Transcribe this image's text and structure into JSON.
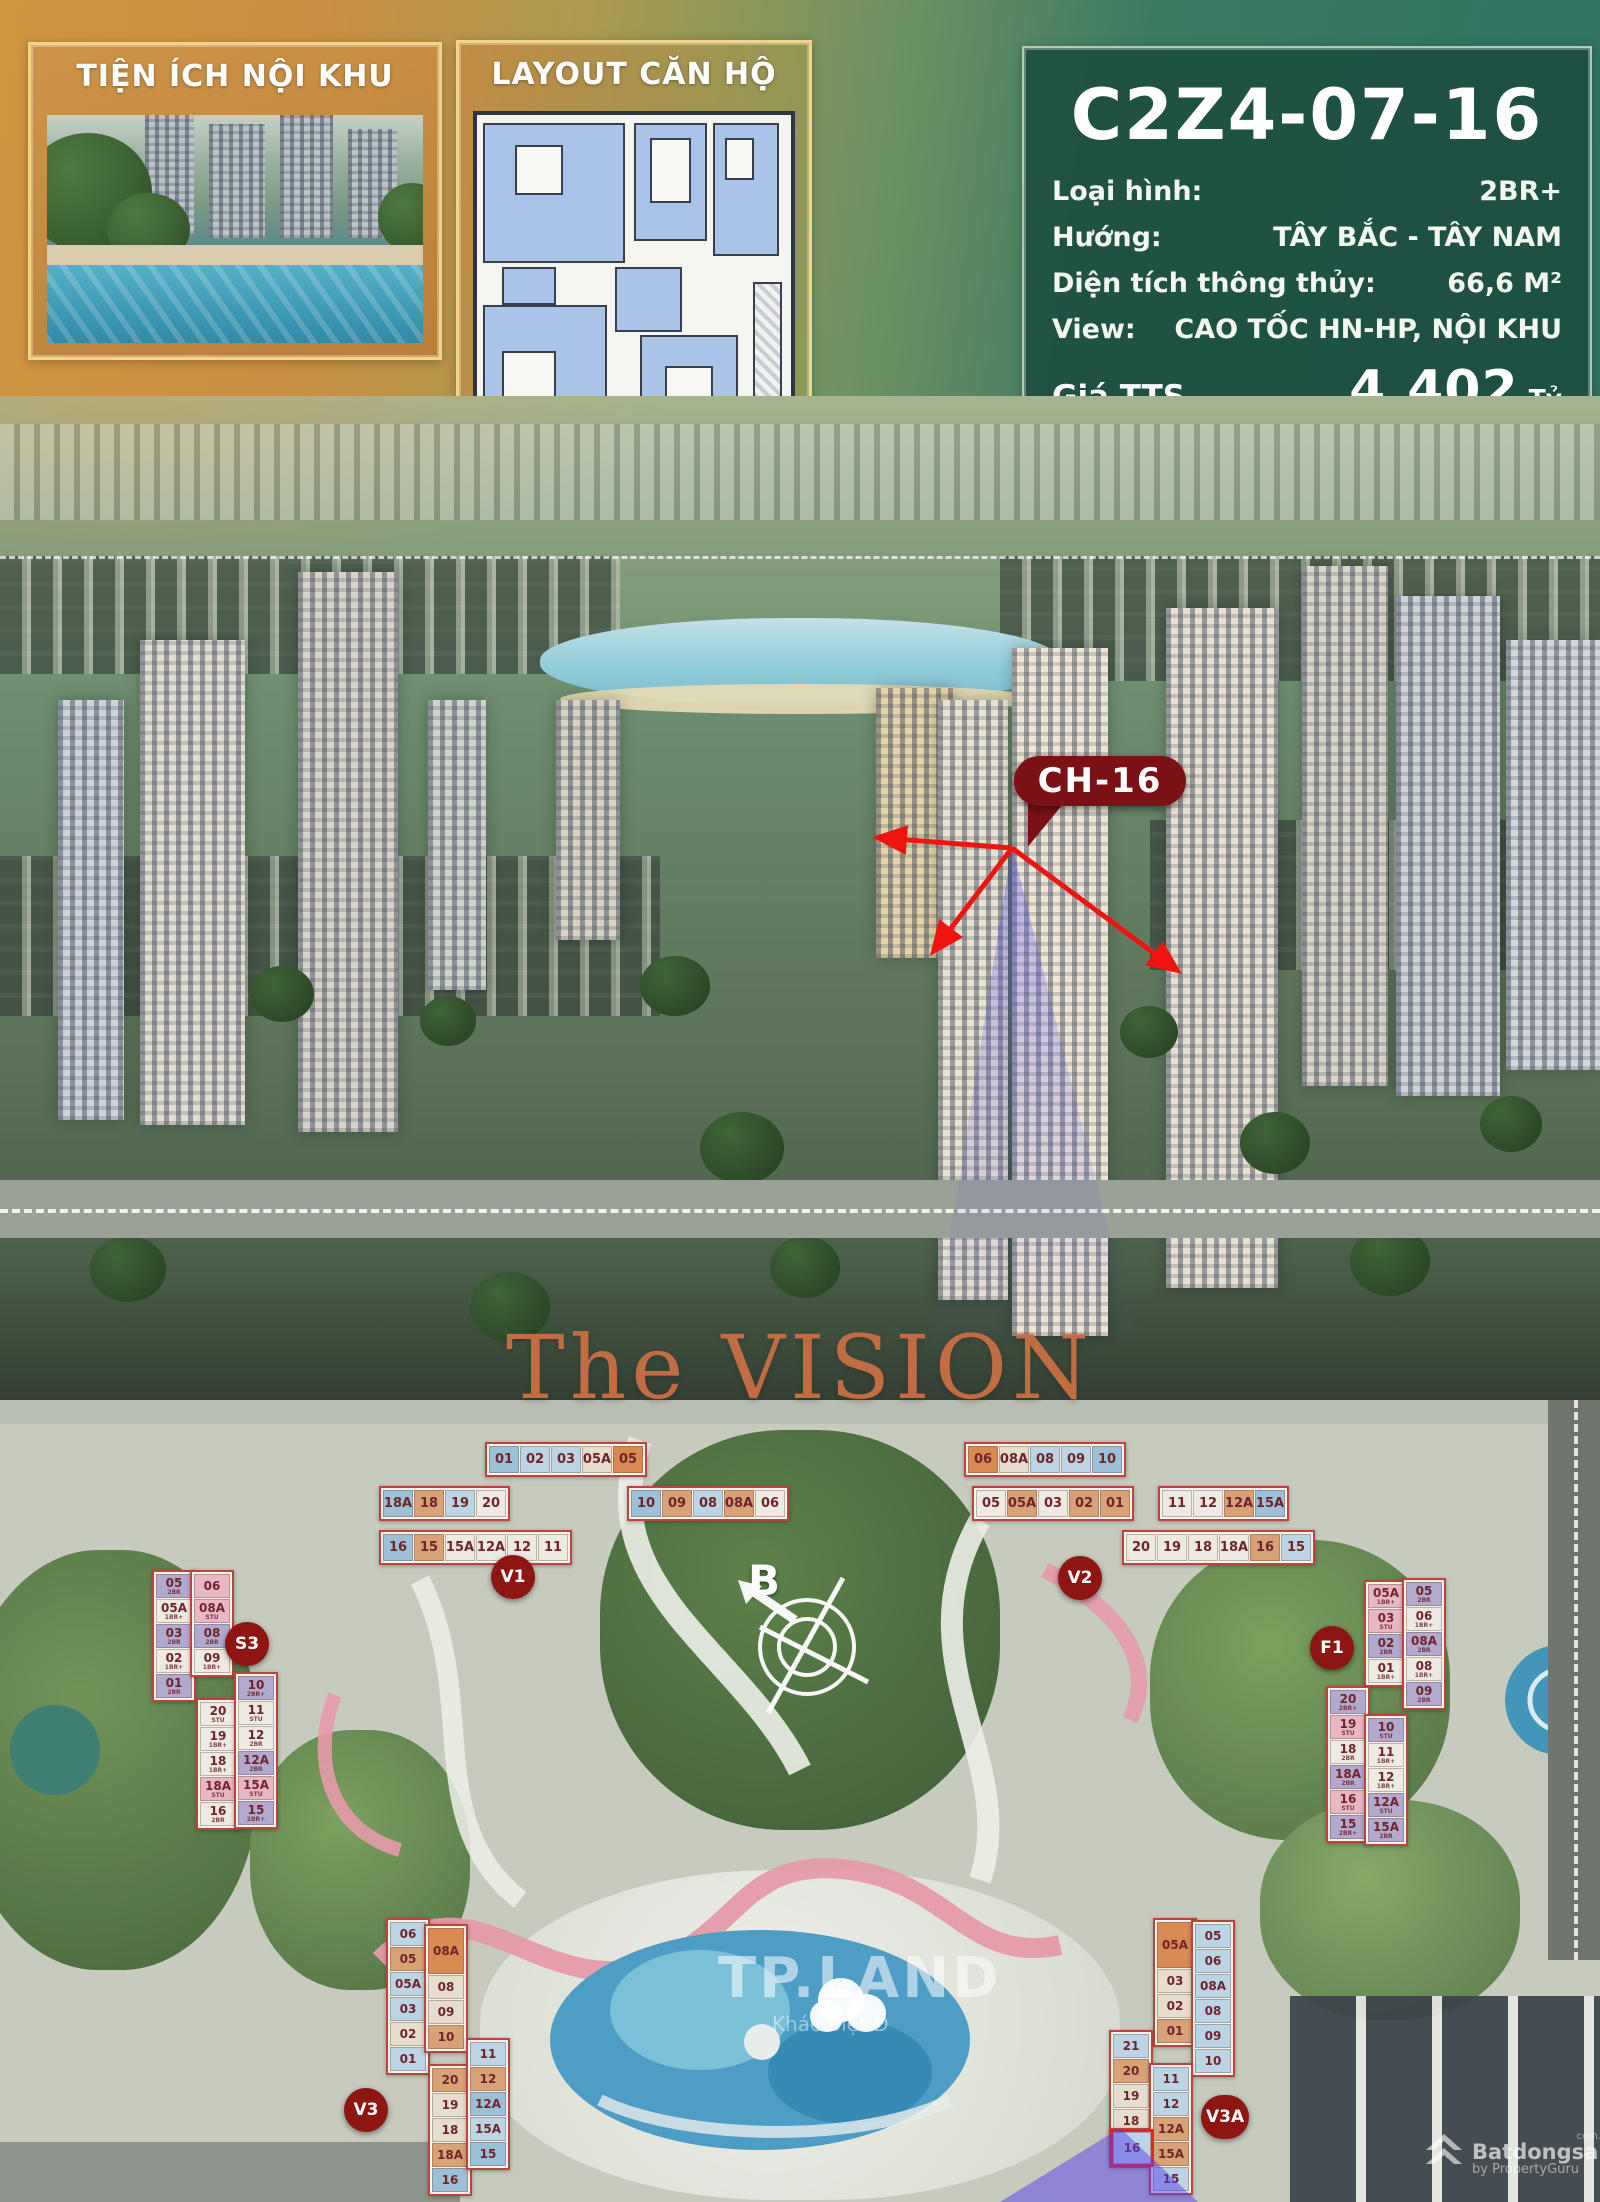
{
  "header": {
    "left_panel_title": "TIỆN ÍCH NỘI KHU",
    "mid_panel_title": "LAYOUT CĂN HỘ",
    "unit_code": "C2Z4-07-16",
    "specs": [
      {
        "label": "Loại hình:",
        "value": "2BR+"
      },
      {
        "label": "Hướng:",
        "value": "TÂY BẮC - TÂY NAM"
      },
      {
        "label": "Diện tích thông thủy:",
        "value": "66,6 M²"
      },
      {
        "label": "View:",
        "value": "CAO TỐC HN-HP, NỘI KHU"
      }
    ],
    "prices": [
      {
        "label": "Giá TTS",
        "value": "4.402",
        "unit": "Tỷ"
      },
      {
        "label": "Giá TTTĐ",
        "value": "4.757",
        "unit": "Tỷ"
      },
      {
        "label": "Giá Vay",
        "value": "5.061",
        "unit": "Tỷ"
      }
    ]
  },
  "aerial": {
    "callout": "CH-16"
  },
  "section_title": "The VISION",
  "site_plan": {
    "compass_label": "B",
    "watermark": {
      "title": "TP.LAND",
      "subtitle": "Khác Biệt Đ"
    },
    "brand": {
      "name": "Batdongsan",
      "domain": "com.vn",
      "byline": "by PropertyGuru"
    },
    "highlight_unit": "16",
    "palette": {
      "b1": "#bcd5e4",
      "b2": "#9cc0d8",
      "tn": "#d7a376",
      "or": "#d98a52",
      "cr": "#e6decd",
      "wh": "#edeae2",
      "lv": "#b2a9ce",
      "pk": "#e8b7c4"
    },
    "buildings": [
      {
        "id": "V1",
        "kind": "h",
        "x": 373,
        "y": 1430,
        "badge": {
          "x": 118,
          "y": 125
        },
        "blocks": [
          {
            "x": 112,
            "y": 12,
            "dir": "row",
            "cells": [
              {
                "t": "01",
                "c": "b2"
              },
              {
                "t": "02",
                "c": "b1"
              },
              {
                "t": "03",
                "c": "b1"
              },
              {
                "t": "05A",
                "c": "cr"
              },
              {
                "t": "05",
                "c": "or"
              }
            ]
          },
          {
            "x": 6,
            "y": 56,
            "dir": "row",
            "cells": [
              {
                "t": "18A",
                "c": "b2"
              },
              {
                "t": "18",
                "c": "tn"
              },
              {
                "t": "19",
                "c": "b1"
              },
              {
                "t": "20",
                "c": "wh"
              }
            ]
          },
          {
            "x": 254,
            "y": 56,
            "dir": "row",
            "cells": [
              {
                "t": "10",
                "c": "b2"
              },
              {
                "t": "09",
                "c": "tn"
              },
              {
                "t": "08",
                "c": "b1"
              },
              {
                "t": "08A",
                "c": "tn"
              },
              {
                "t": "06",
                "c": "wh"
              }
            ]
          },
          {
            "x": 6,
            "y": 100,
            "dir": "row",
            "cells": [
              {
                "t": "16",
                "c": "b2"
              },
              {
                "t": "15",
                "c": "tn"
              },
              {
                "t": "15A",
                "c": "wh"
              },
              {
                "t": "12A",
                "c": "wh"
              },
              {
                "t": "12",
                "c": "wh"
              },
              {
                "t": "11",
                "c": "wh"
              }
            ]
          }
        ]
      },
      {
        "id": "V2",
        "kind": "h",
        "x": 962,
        "y": 1438,
        "badge": {
          "x": 96,
          "y": 118
        },
        "blocks": [
          {
            "x": 2,
            "y": 4,
            "dir": "row",
            "cells": [
              {
                "t": "06",
                "c": "or"
              },
              {
                "t": "08A",
                "c": "cr"
              },
              {
                "t": "08",
                "c": "b1"
              },
              {
                "t": "09",
                "c": "b1"
              },
              {
                "t": "10",
                "c": "b2"
              }
            ]
          },
          {
            "x": 10,
            "y": 48,
            "dir": "row",
            "cells": [
              {
                "t": "05",
                "c": "wh"
              },
              {
                "t": "05A",
                "c": "tn"
              },
              {
                "t": "03",
                "c": "wh"
              },
              {
                "t": "02",
                "c": "tn"
              },
              {
                "t": "01",
                "c": "tn"
              }
            ]
          },
          {
            "x": 196,
            "y": 48,
            "dir": "row",
            "cells": [
              {
                "t": "11",
                "c": "wh"
              },
              {
                "t": "12",
                "c": "wh"
              },
              {
                "t": "12A",
                "c": "tn"
              },
              {
                "t": "15A",
                "c": "b2"
              }
            ]
          },
          {
            "x": 160,
            "y": 92,
            "dir": "row",
            "cells": [
              {
                "t": "20",
                "c": "wh"
              },
              {
                "t": "19",
                "c": "wh"
              },
              {
                "t": "18",
                "c": "wh"
              },
              {
                "t": "18A",
                "c": "wh"
              },
              {
                "t": "16",
                "c": "tn"
              },
              {
                "t": "15",
                "c": "b1"
              }
            ]
          }
        ]
      },
      {
        "id": "S3",
        "kind": "v",
        "x": 130,
        "y": 1566,
        "badge": {
          "x": 95,
          "y": 56
        },
        "blocks": [
          {
            "x": 22,
            "y": 4,
            "dir": "col",
            "cells": [
              {
                "t": "05",
                "c": "lv",
                "sub": "2BR"
              },
              {
                "t": "05A",
                "c": "wh",
                "sub": "1BR+"
              },
              {
                "t": "03",
                "c": "lv",
                "sub": "2BR"
              },
              {
                "t": "02",
                "c": "wh",
                "sub": "1BR+"
              },
              {
                "t": "01",
                "c": "lv",
                "sub": "2BR"
              }
            ]
          },
          {
            "x": 60,
            "y": 4,
            "dir": "col",
            "cells": [
              {
                "t": "06",
                "c": "pk"
              },
              {
                "t": "08A",
                "c": "pk",
                "sub": "STU"
              },
              {
                "t": "08",
                "c": "lv",
                "sub": "2BR"
              },
              {
                "t": "09",
                "c": "wh",
                "sub": "1BR+"
              }
            ]
          },
          {
            "x": 66,
            "y": 132,
            "dir": "col",
            "cells": [
              {
                "t": "20",
                "c": "wh",
                "sub": "STU"
              },
              {
                "t": "19",
                "c": "wh",
                "sub": "1BR+"
              },
              {
                "t": "18",
                "c": "wh",
                "sub": "1BR+"
              },
              {
                "t": "18A",
                "c": "pk",
                "sub": "STU"
              },
              {
                "t": "16",
                "c": "wh",
                "sub": "2BR"
              }
            ]
          },
          {
            "x": 104,
            "y": 106,
            "dir": "col",
            "cells": [
              {
                "t": "10",
                "c": "lv",
                "sub": "2BR+"
              },
              {
                "t": "11",
                "c": "wh",
                "sub": "STU"
              },
              {
                "t": "12",
                "c": "wh",
                "sub": "2BR"
              },
              {
                "t": "12A",
                "c": "lv",
                "sub": "2BR"
              },
              {
                "t": "15A",
                "c": "pk",
                "sub": "STU"
              },
              {
                "t": "15",
                "c": "lv",
                "sub": "2BR+"
              }
            ]
          }
        ]
      },
      {
        "id": "F1",
        "kind": "v",
        "x": 1300,
        "y": 1578,
        "badge": {
          "x": 10,
          "y": 48
        },
        "blocks": [
          {
            "x": 64,
            "y": 2,
            "dir": "col",
            "cells": [
              {
                "t": "05A",
                "c": "pk",
                "sub": "1BR+"
              },
              {
                "t": "03",
                "c": "pk",
                "sub": "STU"
              },
              {
                "t": "02",
                "c": "lv",
                "sub": "2BR"
              },
              {
                "t": "01",
                "c": "wh",
                "sub": "1BR+"
              }
            ]
          },
          {
            "x": 102,
            "y": 0,
            "dir": "col",
            "cells": [
              {
                "t": "05",
                "c": "lv",
                "sub": "2BR"
              },
              {
                "t": "06",
                "c": "wh",
                "sub": "1BR+"
              },
              {
                "t": "08A",
                "c": "lv",
                "sub": "2BR"
              },
              {
                "t": "08",
                "c": "wh",
                "sub": "1BR+"
              },
              {
                "t": "09",
                "c": "lv",
                "sub": "2BR"
              }
            ]
          },
          {
            "x": 26,
            "y": 108,
            "dir": "col",
            "cells": [
              {
                "t": "20",
                "c": "lv",
                "sub": "2BR+"
              },
              {
                "t": "19",
                "c": "pk",
                "sub": "STU"
              },
              {
                "t": "18",
                "c": "wh",
                "sub": "2BR"
              },
              {
                "t": "18A",
                "c": "lv",
                "sub": "2BR"
              },
              {
                "t": "16",
                "c": "pk",
                "sub": "STU"
              },
              {
                "t": "15",
                "c": "lv",
                "sub": "2BR+"
              }
            ]
          },
          {
            "x": 64,
            "y": 136,
            "dir": "col",
            "cells": [
              {
                "t": "10",
                "c": "lv",
                "sub": "STU"
              },
              {
                "t": "11",
                "c": "wh",
                "sub": "1BR+"
              },
              {
                "t": "12",
                "c": "wh",
                "sub": "1BR+"
              },
              {
                "t": "12A",
                "c": "lv",
                "sub": "STU"
              },
              {
                "t": "15A",
                "c": "lv",
                "sub": "2BR"
              }
            ]
          }
        ]
      },
      {
        "id": "V3",
        "kind": "v",
        "x": 378,
        "y": 1912,
        "badge": {
          "x": -34,
          "y": 176
        },
        "blocks": [
          {
            "x": 8,
            "y": 6,
            "dir": "col",
            "cells": [
              {
                "t": "06",
                "c": "b1"
              },
              {
                "t": "05",
                "c": "tn"
              },
              {
                "t": "05A",
                "c": "b1"
              },
              {
                "t": "03",
                "c": "b1"
              },
              {
                "t": "02",
                "c": "cr"
              },
              {
                "t": "01",
                "c": "b1"
              }
            ]
          },
          {
            "x": 46,
            "y": 12,
            "dir": "col",
            "cells": [
              {
                "t": "08A",
                "c": "or",
                "h": 46
              },
              {
                "t": "08",
                "c": "cr"
              },
              {
                "t": "09",
                "c": "cr"
              },
              {
                "t": "10",
                "c": "tn"
              }
            ]
          },
          {
            "x": 50,
            "y": 152,
            "dir": "col",
            "cells": [
              {
                "t": "20",
                "c": "tn"
              },
              {
                "t": "19",
                "c": "cr"
              },
              {
                "t": "18",
                "c": "cr"
              },
              {
                "t": "18A",
                "c": "tn"
              },
              {
                "t": "16",
                "c": "b2"
              }
            ]
          },
          {
            "x": 88,
            "y": 126,
            "dir": "col",
            "cells": [
              {
                "t": "11",
                "c": "b1"
              },
              {
                "t": "12",
                "c": "tn"
              },
              {
                "t": "12A",
                "c": "b2"
              },
              {
                "t": "15A",
                "c": "b1"
              },
              {
                "t": "15",
                "c": "b2"
              }
            ]
          }
        ]
      },
      {
        "id": "V3A",
        "kind": "v",
        "x": 1085,
        "y": 1905,
        "badge": {
          "x": 116,
          "y": 190
        },
        "blocks": [
          {
            "x": 68,
            "y": 13,
            "dir": "col",
            "cells": [
              {
                "t": "05A",
                "c": "or",
                "h": 46
              },
              {
                "t": "03",
                "c": "cr"
              },
              {
                "t": "02",
                "c": "cr"
              },
              {
                "t": "01",
                "c": "tn"
              }
            ]
          },
          {
            "x": 106,
            "y": 15,
            "dir": "col",
            "cells": [
              {
                "t": "05",
                "c": "b1"
              },
              {
                "t": "06",
                "c": "b1"
              },
              {
                "t": "08A",
                "c": "b1"
              },
              {
                "t": "08",
                "c": "b1"
              },
              {
                "t": "09",
                "c": "b1"
              },
              {
                "t": "10",
                "c": "b1"
              }
            ]
          },
          {
            "x": 24,
            "y": 125,
            "dir": "col",
            "cells": [
              {
                "t": "21",
                "c": "b1"
              },
              {
                "t": "20",
                "c": "tn"
              },
              {
                "t": "19",
                "c": "cr"
              },
              {
                "t": "18",
                "c": "cr"
              },
              {
                "t": "18A",
                "c": "tn"
              }
            ]
          },
          {
            "x": 24,
            "y": 223,
            "dir": "col",
            "cells": [
              {
                "t": "16",
                "c": "b1",
                "hl": true,
                "w": 38,
                "h": 32
              }
            ]
          },
          {
            "x": 64,
            "y": 158,
            "dir": "col",
            "cells": [
              {
                "t": "11",
                "c": "b1"
              },
              {
                "t": "12",
                "c": "b1"
              },
              {
                "t": "12A",
                "c": "tn"
              },
              {
                "t": "15A",
                "c": "tn"
              },
              {
                "t": "15",
                "c": "b1"
              }
            ]
          }
        ]
      }
    ]
  },
  "colors": {
    "accent_red": "#8e1612",
    "callout_red": "#7c1115",
    "panel_green": "#2c6353",
    "panel_orange": "#c28742",
    "gold_border": "#f0d684",
    "vision_orange": "#c96f43"
  }
}
